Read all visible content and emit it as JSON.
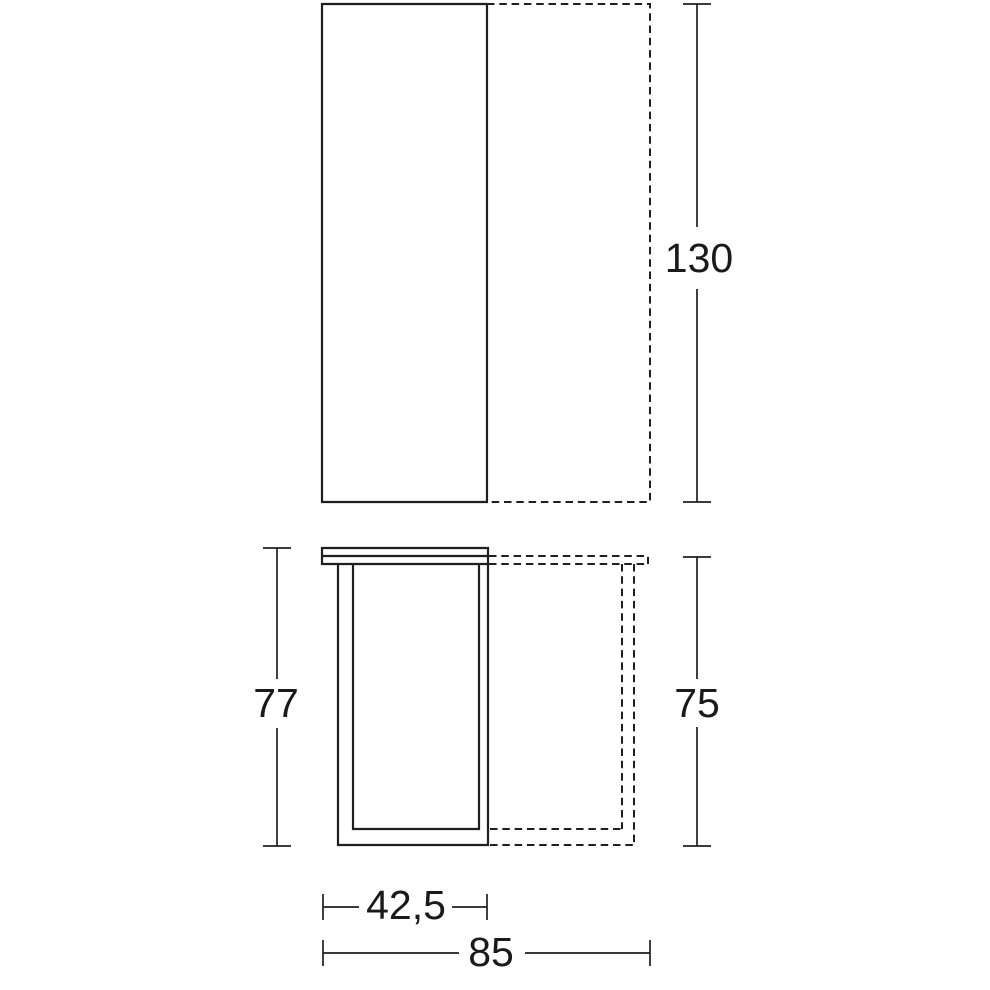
{
  "colors": {
    "background": "#ffffff",
    "line": "#1f1f1f",
    "text": "#1a1a1a"
  },
  "dimensions": {
    "plan_length": "130",
    "side_height_total": "77",
    "side_height_extension": "75",
    "depth_closed": "42,5",
    "depth_extended": "85"
  }
}
